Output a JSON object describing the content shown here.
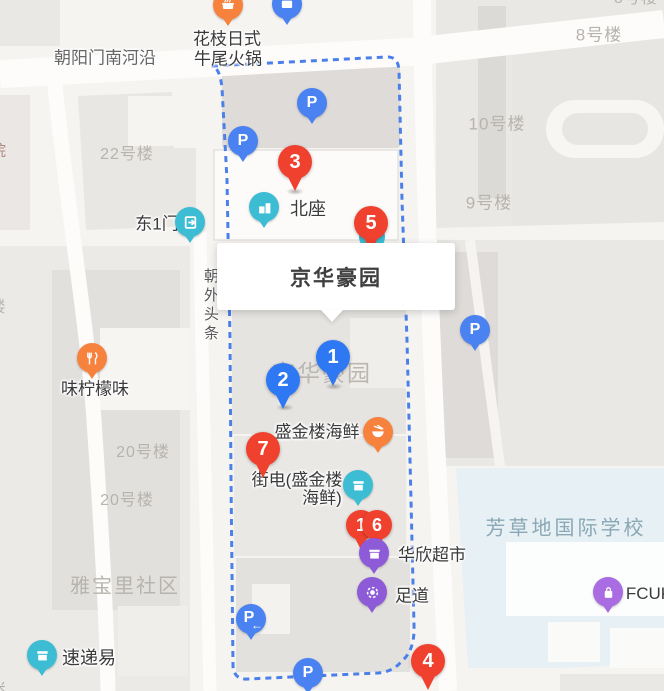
{
  "popup": {
    "title": "京华豪园"
  },
  "roads": {
    "chaoyangmen_nanheyan": "朝阳门南河沿",
    "chaowai_toutiao": "朝外头条"
  },
  "areas": {
    "building_22": "22号楼",
    "building_8_partial": "8号楼",
    "building_8": "8号楼",
    "building_10": "10号楼",
    "building_9": "9号楼",
    "building_20_upper": "20号楼",
    "building_20_lower": "20号楼",
    "yabaoli_community": "雅宝里社区",
    "jinghua_haoyuan_map_label": "京华豪园",
    "fangcaodi_school": "芳草地国际学校",
    "edge_partial_yuan": "院",
    "edge_partial_lou": "楼",
    "edge_partial_mi": "米"
  },
  "pois": {
    "huazhi_hotpot": {
      "line1": "花枝日式",
      "line2": "牛尾火锅"
    },
    "east_gate_1": {
      "name": "东1门"
    },
    "beizuo": {
      "name": "北座"
    },
    "lemon_restaurant": {
      "name": "味柠檬味"
    },
    "shengjinlou_seafood": {
      "name": "盛金楼海鲜"
    },
    "jiedian": {
      "line1": "街电(盛金楼",
      "line2": "海鲜)"
    },
    "huaxin_market": {
      "name": "华欣超市"
    },
    "zudao": {
      "name": "足道"
    },
    "sudiyi": {
      "name": "速递易"
    },
    "fcuk_store": {
      "name": "FCUK"
    }
  },
  "parking": {
    "label": "P",
    "entrance_arrow": "←"
  },
  "markers": {
    "m3": "3",
    "m5": "5",
    "m1_blue": "1",
    "m2": "2",
    "m7": "7",
    "m1_red": "1",
    "m6": "6",
    "m4": "4"
  },
  "colors": {
    "marker_red": "#f0402e",
    "marker_blue": "#2e78f3",
    "parking_blue": "#4b82f1",
    "teal": "#3dbdd4",
    "orange": "#f6823d",
    "purple": "#8d5bd8",
    "purple_light": "#a96ce2",
    "boundary": "#4c80e9",
    "school_text": "#8aa8b6",
    "area_text": "#b7b3ae",
    "school_fill": "#e7f0f4"
  }
}
